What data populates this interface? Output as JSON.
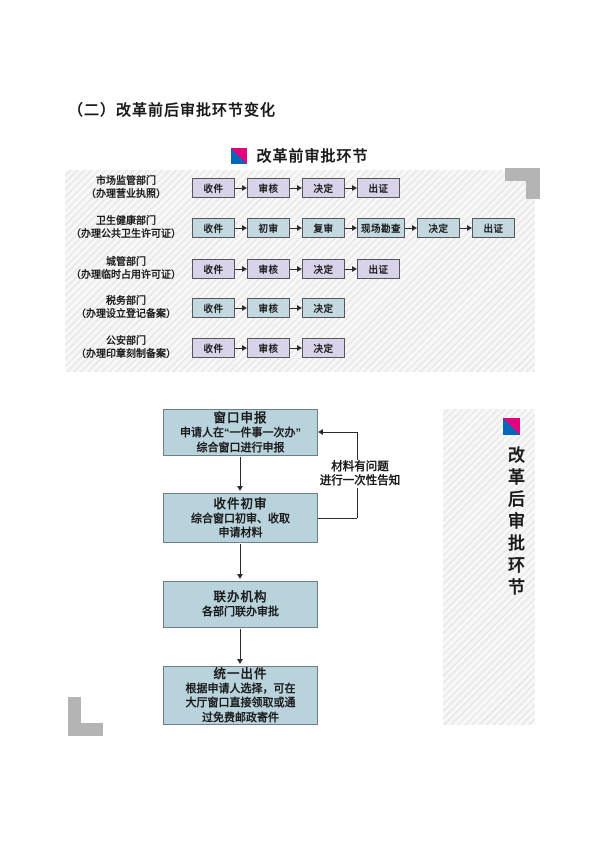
{
  "page_title": "（二）改革前后审批环节变化",
  "before": {
    "heading": "改革前审批环节",
    "rows": [
      {
        "dept": "市场监管部门",
        "note": "（办理营业执照）",
        "style": "lavender",
        "steps": [
          "收件",
          "审核",
          "决定",
          "出证"
        ]
      },
      {
        "dept": "卫生健康部门",
        "note": "（办理公共卫生许可证）",
        "style": "blue",
        "steps": [
          "收件",
          "初审",
          "复审",
          "现场勘查",
          "决定",
          "出证"
        ]
      },
      {
        "dept": "城管部门",
        "note": "（办理临时占用许可证）",
        "style": "lavender",
        "steps": [
          "收件",
          "审核",
          "决定",
          "出证"
        ]
      },
      {
        "dept": "税务部门",
        "note": "（办理设立登记备案）",
        "style": "blue",
        "steps": [
          "收件",
          "审核",
          "决定"
        ]
      },
      {
        "dept": "公安部门",
        "note": "（办理印章刻制备案）",
        "style": "lavender",
        "steps": [
          "收件",
          "审核",
          "决定"
        ]
      }
    ]
  },
  "after": {
    "heading": "改革后审批环节",
    "boxes": [
      {
        "title": "窗口申报",
        "lines": [
          "申请人在“一件事一次办”",
          "综合窗口进行申报"
        ]
      },
      {
        "title": "收件初审",
        "lines": [
          "综合窗口初审、收取",
          "申请材料"
        ]
      },
      {
        "title": "联办机构",
        "lines": [
          "各部门联办审批"
        ]
      },
      {
        "title": "统一出件",
        "lines": [
          "根据申请人选择，可在",
          "大厅窗口直接领取或通",
          "过免费邮政寄件"
        ]
      }
    ],
    "feedback_note": [
      "材料有问题",
      "进行一次性告知"
    ]
  },
  "icons": {
    "section_marker": "split-square-icon"
  },
  "colors": {
    "accent_magenta": "#e4007f",
    "accent_blue": "#0068b7",
    "box_lavender": "#d9d3e9",
    "box_blue": "#c3d8df",
    "flow_box_blue": "#b9d3dd",
    "bracket_gray": "#b4b4b4"
  }
}
